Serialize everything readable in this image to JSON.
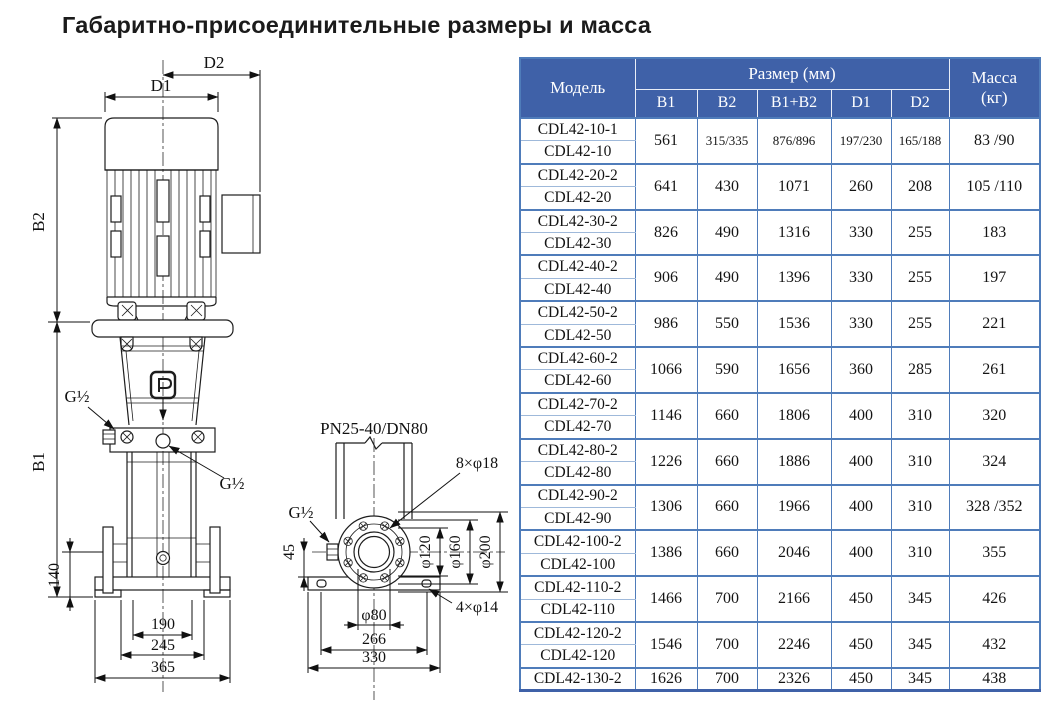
{
  "title": "Габаритно-присоединительные размеры и масса",
  "colors": {
    "header_bg": "#3f61a8",
    "table_border": "#4f7cba",
    "pair_divider": "#9fb9da",
    "line": "#1d1d1d"
  },
  "table": {
    "header": {
      "model": "Модель",
      "size_group": "Размер (мм)",
      "mass_line1": "Масса",
      "mass_line2": "(кг)",
      "cols": [
        "B1",
        "B2",
        "B1+B2",
        "D1",
        "D2"
      ]
    },
    "groups": [
      {
        "models": [
          "CDL42-10-1",
          "CDL42-10"
        ],
        "b1": "561",
        "b2": "315/335",
        "b1b2": "876/896",
        "d1": "197/230",
        "d2": "165/188",
        "mass": "83 /90"
      },
      {
        "models": [
          "CDL42-20-2",
          "CDL42-20"
        ],
        "b1": "641",
        "b2": "430",
        "b1b2": "1071",
        "d1": "260",
        "d2": "208",
        "mass": "105 /110"
      },
      {
        "models": [
          "CDL42-30-2",
          "CDL42-30"
        ],
        "b1": "826",
        "b2": "490",
        "b1b2": "1316",
        "d1": "330",
        "d2": "255",
        "mass": "183"
      },
      {
        "models": [
          "CDL42-40-2",
          "CDL42-40"
        ],
        "b1": "906",
        "b2": "490",
        "b1b2": "1396",
        "d1": "330",
        "d2": "255",
        "mass": "197"
      },
      {
        "models": [
          "CDL42-50-2",
          "CDL42-50"
        ],
        "b1": "986",
        "b2": "550",
        "b1b2": "1536",
        "d1": "330",
        "d2": "255",
        "mass": "221"
      },
      {
        "models": [
          "CDL42-60-2",
          "CDL42-60"
        ],
        "b1": "1066",
        "b2": "590",
        "b1b2": "1656",
        "d1": "360",
        "d2": "285",
        "mass": "261"
      },
      {
        "models": [
          "CDL42-70-2",
          "CDL42-70"
        ],
        "b1": "1146",
        "b2": "660",
        "b1b2": "1806",
        "d1": "400",
        "d2": "310",
        "mass": "320"
      },
      {
        "models": [
          "CDL42-80-2",
          "CDL42-80"
        ],
        "b1": "1226",
        "b2": "660",
        "b1b2": "1886",
        "d1": "400",
        "d2": "310",
        "mass": "324"
      },
      {
        "models": [
          "CDL42-90-2",
          "CDL42-90"
        ],
        "b1": "1306",
        "b2": "660",
        "b1b2": "1966",
        "d1": "400",
        "d2": "310",
        "mass": "328 /352"
      },
      {
        "models": [
          "CDL42-100-2",
          "CDL42-100"
        ],
        "b1": "1386",
        "b2": "660",
        "b1b2": "2046",
        "d1": "400",
        "d2": "310",
        "mass": "355"
      },
      {
        "models": [
          "CDL42-110-2",
          "CDL42-110"
        ],
        "b1": "1466",
        "b2": "700",
        "b1b2": "2166",
        "d1": "450",
        "d2": "345",
        "mass": "426"
      },
      {
        "models": [
          "CDL42-120-2",
          "CDL42-120"
        ],
        "b1": "1546",
        "b2": "700",
        "b1b2": "2246",
        "d1": "450",
        "d2": "345",
        "mass": "432"
      },
      {
        "models": [
          "CDL42-130-2"
        ],
        "b1": "1626",
        "b2": "700",
        "b1b2": "2326",
        "d1": "450",
        "d2": "345",
        "mass": "438"
      }
    ]
  },
  "drawing": {
    "labels": {
      "d2": "D2",
      "d1": "D1",
      "b2": "B2",
      "b1": "B1",
      "g_half_left": "G½",
      "g_half_center": "G½",
      "g_half_side": "G½",
      "dim_140": "140",
      "dim_190": "190",
      "dim_245": "245",
      "dim_365": "365",
      "flange_spec": "PN25-40/DN80",
      "bolt_holes_8": "8×φ18",
      "dim_45": "45",
      "phi_120": "φ120",
      "phi_160": "φ160",
      "phi_200": "φ200",
      "phi_80": "φ80",
      "dim_266": "266",
      "dim_330": "330",
      "bolt_holes_4": "4×φ14"
    }
  }
}
